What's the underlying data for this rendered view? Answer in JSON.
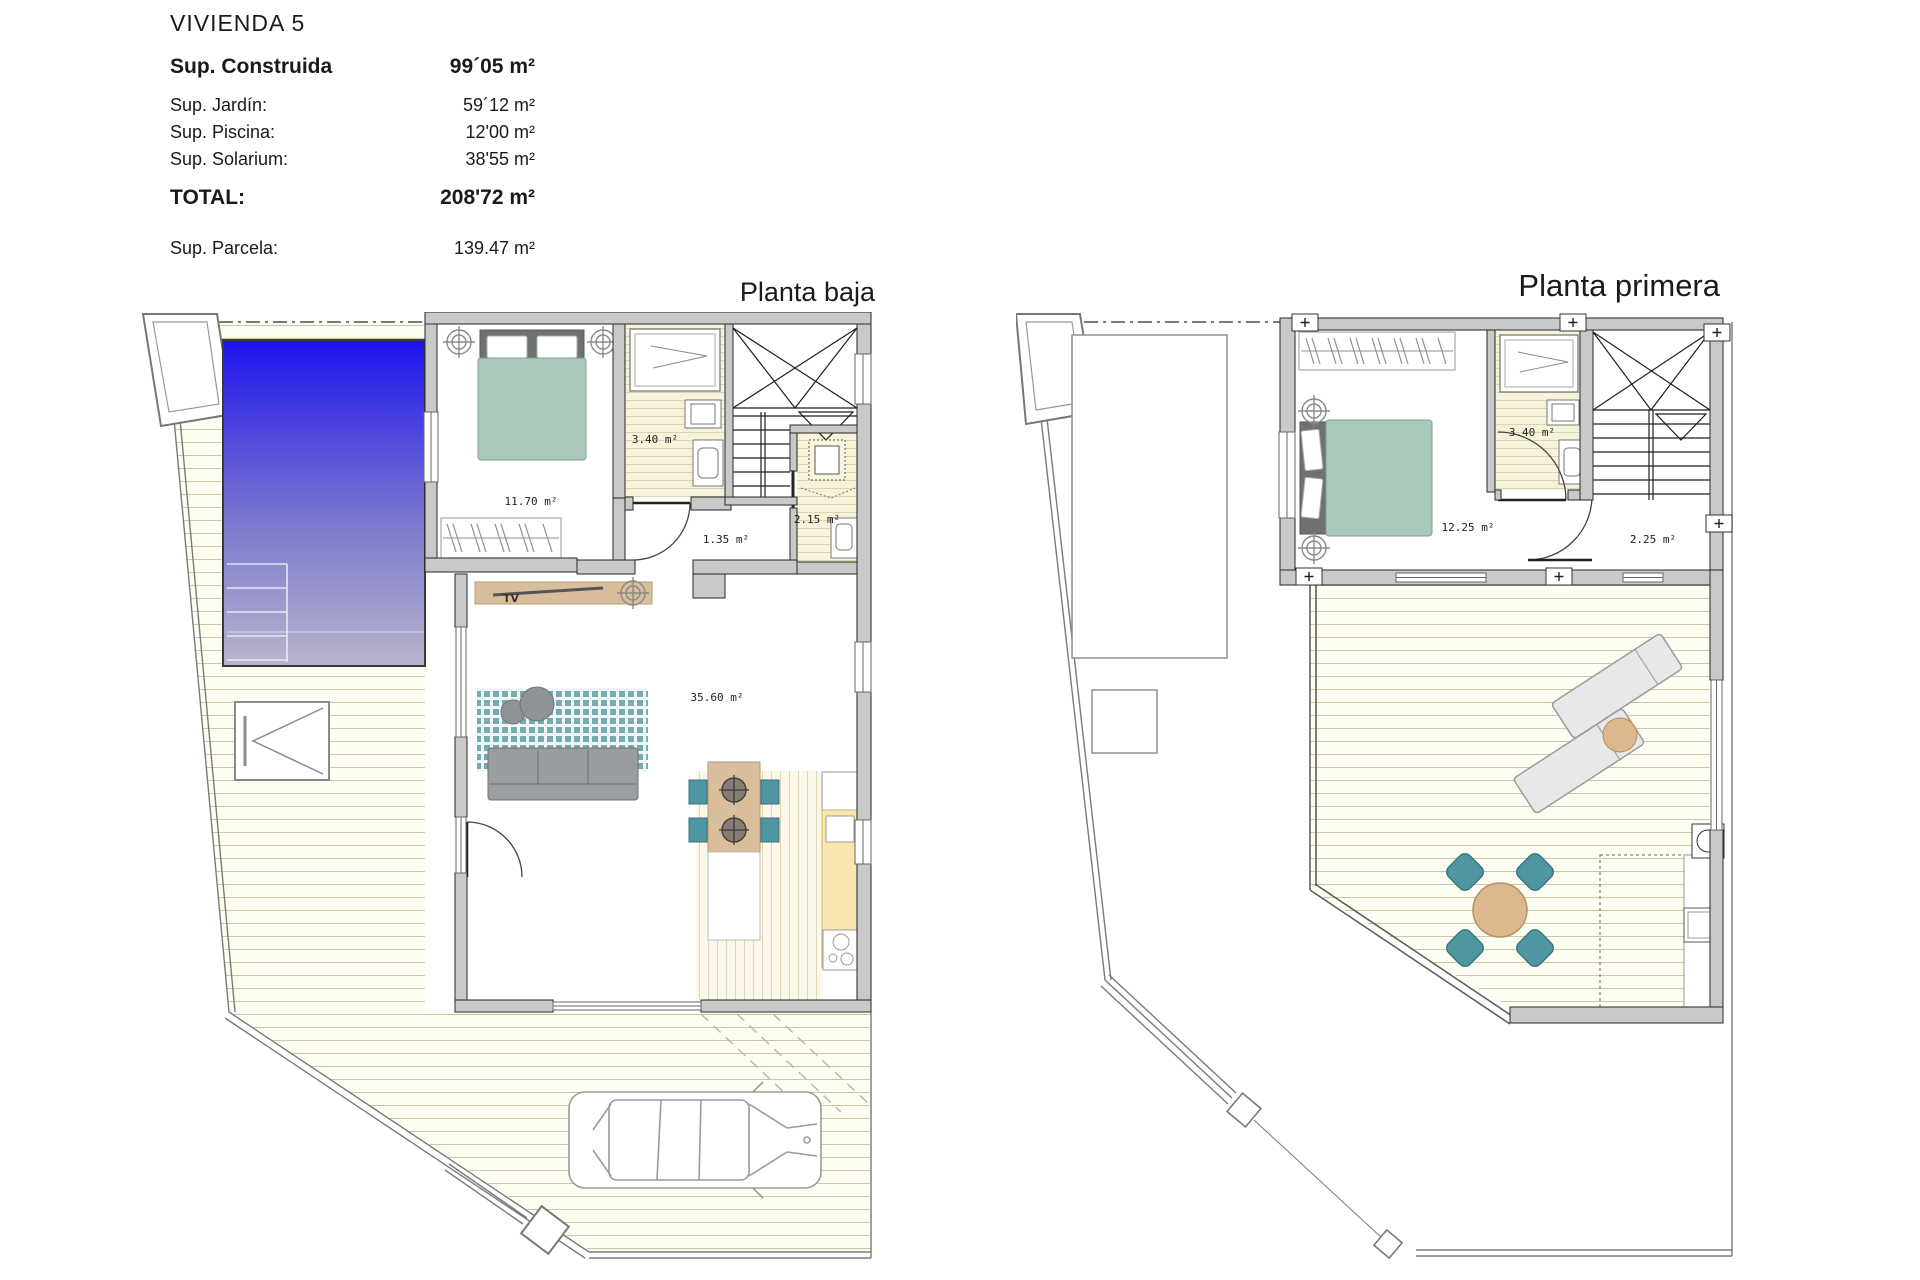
{
  "header": {
    "title": "VIVIENDA 5",
    "construida_label": "Sup. Construida",
    "construida_value": "99´05 m²",
    "rows": [
      {
        "label": "Sup. Jardín:",
        "value": "59´12 m²"
      },
      {
        "label": "Sup. Piscina:",
        "value": "12'00 m²"
      },
      {
        "label": "Sup. Solarium:",
        "value": "38'55 m²"
      }
    ],
    "total_label": "TOTAL:",
    "total_value": "208'72 m²",
    "parcela_label": "Sup. Parcela:",
    "parcela_value": "139.47 m²"
  },
  "plans": {
    "ground": {
      "title": "Planta baja",
      "rooms": {
        "bedroom": "11.70 m²",
        "bathroom": "3.40 m²",
        "hall": "1.35 m²",
        "wc": "2.15 m²",
        "living": "35.60 m²"
      },
      "tv": "TV"
    },
    "first": {
      "title": "Planta primera",
      "rooms": {
        "bedroom": "12.25 m²",
        "bathroom": "3.40 m²",
        "landing": "2.25 m²"
      }
    }
  },
  "colors": {
    "pool_blue": "#1e13ee",
    "pool_fade": "#b7b5cc",
    "wall_gray": "#c9c9c9",
    "sage_green": "#a9c8b9",
    "teal": "#4f96a3",
    "tan": "#d9be9c",
    "counter_yellow": "#f8e7b0",
    "rug_teal": "#76abb0"
  }
}
